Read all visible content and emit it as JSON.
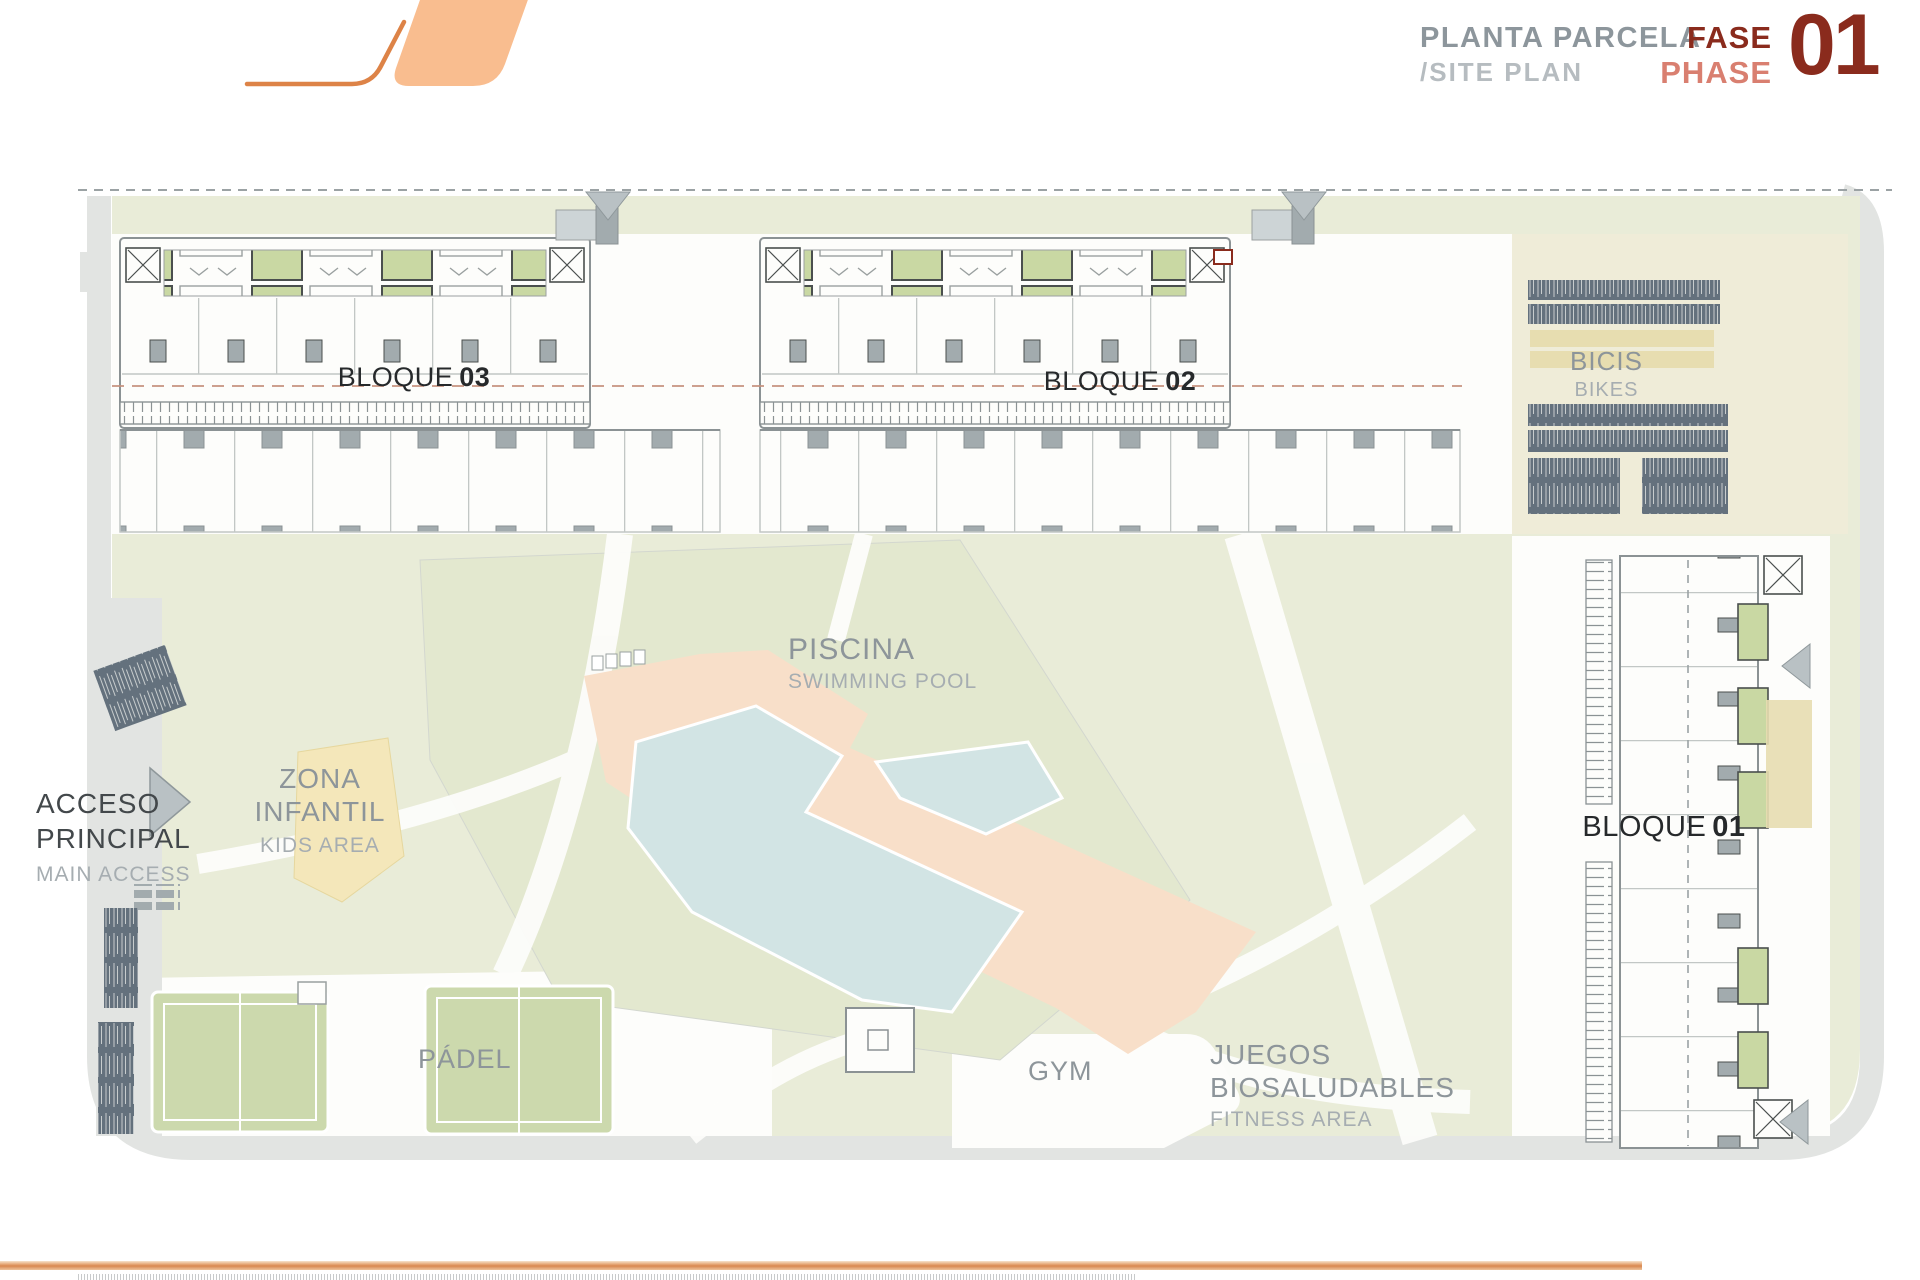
{
  "header": {
    "title_es": "PLANTA PARCELA",
    "title_en": "/SITE PLAN",
    "fase": "FASE",
    "phase": "PHASE",
    "number": "01"
  },
  "plan": {
    "labels": {
      "bloque03": {
        "name": "BLOQUE",
        "number": "03"
      },
      "bloque02": {
        "name": "BLOQUE",
        "number": "02"
      },
      "bloque01": {
        "name": "BLOQUE",
        "number": "01"
      },
      "bicis": {
        "es": "BICIS",
        "en": "BIKES"
      },
      "piscina": {
        "es": "PISCINA",
        "en": "SWIMMING POOL"
      },
      "zona_infantil": {
        "es1": "ZONA",
        "es2": "INFANTIL",
        "en": "KIDS AREA"
      },
      "acceso": {
        "es1": "ACCESO",
        "es2": "PRINCIPAL",
        "en": "MAIN ACCESS"
      },
      "padel": {
        "es": "PÁDEL"
      },
      "gym": {
        "es": "GYM"
      },
      "juegos": {
        "es1": "JUEGOS",
        "es2": "BIOSALUDABLES",
        "en": "FITNESS AREA"
      }
    }
  },
  "colors": {
    "paper": "#fdfdfb",
    "title_gray": "#8d969c",
    "title_gray_light": "#b6bcc0",
    "phase_dark": "#8a2b1d",
    "phase_salmon": "#d97f70",
    "logo_fill": "#f9bd8f",
    "logo_stroke": "#dd8347",
    "lawn": "#e9ecd8",
    "lawn_deep": "#e3e8cf",
    "road": "#e2e4e2",
    "cream": "#efecd8",
    "sand": "#e7ddb0",
    "unit_green": "#c9d8a3",
    "court_green": "#ccd9ad",
    "pool_deck": "#f8dfc9",
    "pool_water": "#d2e4e4",
    "kids_yellow": "#f4e7ba",
    "ink": "#4a4f4e",
    "ink_soft": "#8b9294",
    "line": "#9aa0a0",
    "line_light": "#c2c7c5",
    "struct_gray": "#a2abae",
    "arrow_gray": "#b9c1c4",
    "bike_dark": "#64717d",
    "dash_red": "#c48f7b",
    "dash_gray": "#9ba2a4",
    "label_dark": "#43484b",
    "label_gray": "#8d959a",
    "label_light": "#a6adb1",
    "bloque_ink": "#26292b",
    "footer_orange": "#d8874f"
  }
}
